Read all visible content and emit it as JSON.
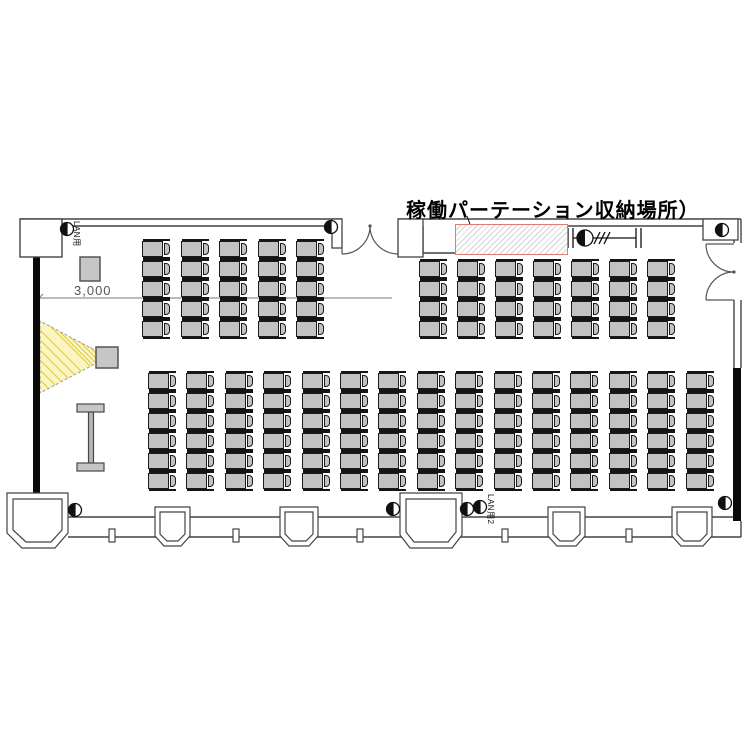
{
  "texts": {
    "title": "稼働パーテーション収納場所）",
    "dimension": "3,000",
    "lan_top": "LAN用",
    "lan_bottom": "LAN用2"
  },
  "colors": {
    "background": "#ffffff",
    "wall_line": "#444444",
    "partition_wall": "#0a0a0a",
    "chair_fill": "#c2c2c2",
    "chair_border": "#1b1b1b",
    "beam_fill": "#fbf5c4",
    "beam_hatch": "#d9c84a",
    "storage_outline": "#dd7b7b",
    "equipment_fill": "#c6c6c6",
    "dimension_color": "#555555"
  },
  "seating": {
    "total_chairs": 143,
    "blocks": [
      {
        "name": "front-left",
        "cols": 5,
        "rows": 5,
        "x": 142,
        "y": 240,
        "dx": 38.5,
        "dy": 20
      },
      {
        "name": "front-right",
        "cols": 7,
        "rows": 4,
        "x": 419,
        "y": 260,
        "dx": 38.0,
        "dy": 20
      },
      {
        "name": "rear",
        "cols": 15,
        "rows": 6,
        "x": 148,
        "y": 372,
        "dx": 38.4,
        "dy": 20
      }
    ]
  },
  "outlets": {
    "count": 8,
    "positions": [
      [
        67,
        229
      ],
      [
        331,
        227
      ],
      [
        722,
        230
      ],
      [
        725,
        503
      ],
      [
        75,
        510
      ],
      [
        393,
        509
      ],
      [
        467,
        509
      ],
      [
        480,
        507
      ]
    ]
  }
}
